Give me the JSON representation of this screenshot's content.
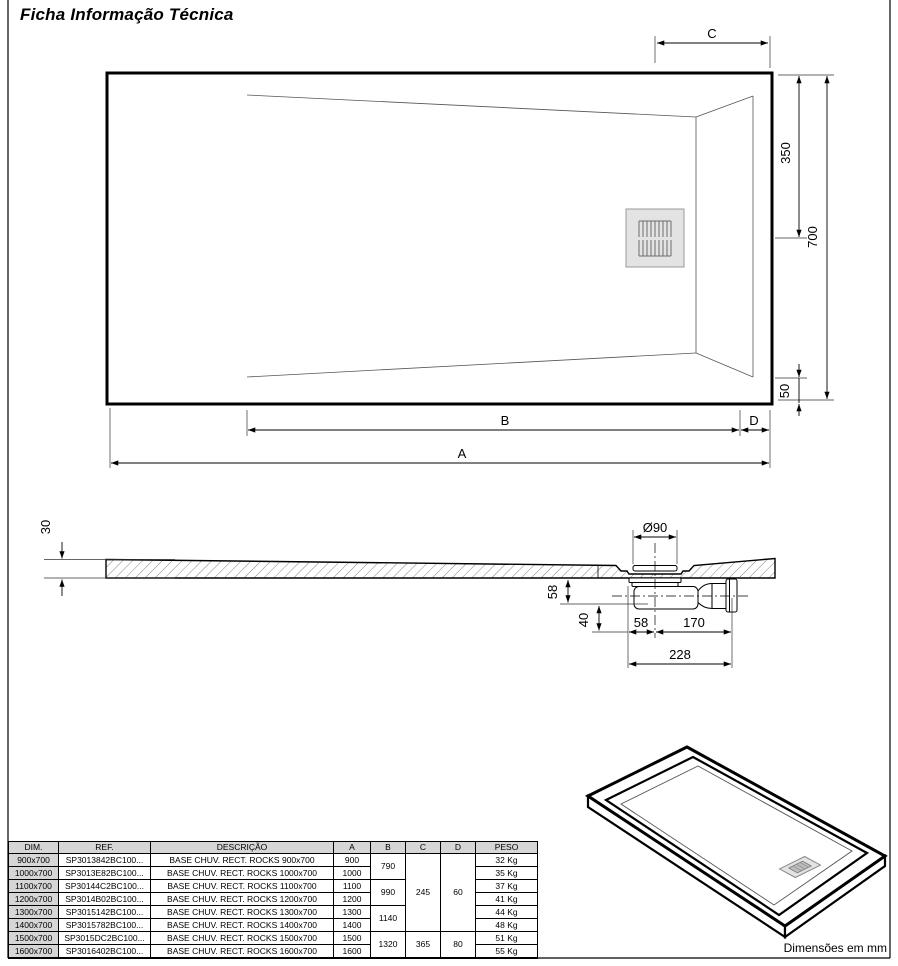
{
  "page": {
    "title": "Ficha Informação Técnica",
    "units_note": "Dimensões em mm"
  },
  "dims": {
    "c": "C",
    "b": "B",
    "d": "D",
    "a": "A",
    "d350": "350",
    "d700": "700",
    "d50": "50",
    "d30": "30",
    "dia90": "Ø90",
    "d58v": "58",
    "d40": "40",
    "d58h": "58",
    "d170": "170",
    "d228": "228"
  },
  "table": {
    "headers": [
      "DIM.",
      "REF.",
      "DESCRIÇÃO",
      "A",
      "B",
      "C",
      "D",
      "PESO"
    ],
    "rows": [
      {
        "dim": "900x700",
        "ref": "SP3013842BC100...",
        "desc": "BASE CHUV. RECT. ROCKS 900x700",
        "a": "900",
        "peso": "32 Kg"
      },
      {
        "dim": "1000x700",
        "ref": "SP3013E82BC100...",
        "desc": "BASE CHUV. RECT. ROCKS 1000x700",
        "a": "1000",
        "peso": "35 Kg"
      },
      {
        "dim": "1100x700",
        "ref": "SP30144C2BC100...",
        "desc": "BASE CHUV. RECT. ROCKS 1100x700",
        "a": "1100",
        "peso": "37 Kg"
      },
      {
        "dim": "1200x700",
        "ref": "SP3014B02BC100...",
        "desc": "BASE CHUV. RECT. ROCKS 1200x700",
        "a": "1200",
        "peso": "41 Kg"
      },
      {
        "dim": "1300x700",
        "ref": "SP3015142BC100...",
        "desc": "BASE CHUV. RECT. ROCKS 1300x700",
        "a": "1300",
        "peso": "44 Kg"
      },
      {
        "dim": "1400x700",
        "ref": "SP3015782BC100...",
        "desc": "BASE CHUV. RECT. ROCKS 1400x700",
        "a": "1400",
        "peso": "48 Kg"
      },
      {
        "dim": "1500x700",
        "ref": "SP3015DC2BC100...",
        "desc": "BASE CHUV. RECT. ROCKS 1500x700",
        "a": "1500",
        "peso": "51 Kg"
      },
      {
        "dim": "1600x700",
        "ref": "SP3016402BC100...",
        "desc": "BASE CHUV. RECT. ROCKS 1600x700",
        "a": "1600",
        "peso": "55 Kg"
      }
    ],
    "merges": {
      "b": [
        {
          "start": 0,
          "span": 2,
          "value": "790"
        },
        {
          "start": 2,
          "span": 2,
          "value": "990"
        },
        {
          "start": 4,
          "span": 2,
          "value": "1140"
        },
        {
          "start": 6,
          "span": 2,
          "value": "1320"
        }
      ],
      "c": [
        {
          "start": 0,
          "span": 6,
          "value": "245"
        },
        {
          "start": 6,
          "span": 2,
          "value": "365"
        }
      ],
      "d": [
        {
          "start": 0,
          "span": 6,
          "value": "60"
        },
        {
          "start": 6,
          "span": 2,
          "value": "80"
        }
      ]
    }
  },
  "colors": {
    "line": "#000000",
    "shade": "#d6d6d6",
    "drain_fill": "#e3e3e3"
  }
}
